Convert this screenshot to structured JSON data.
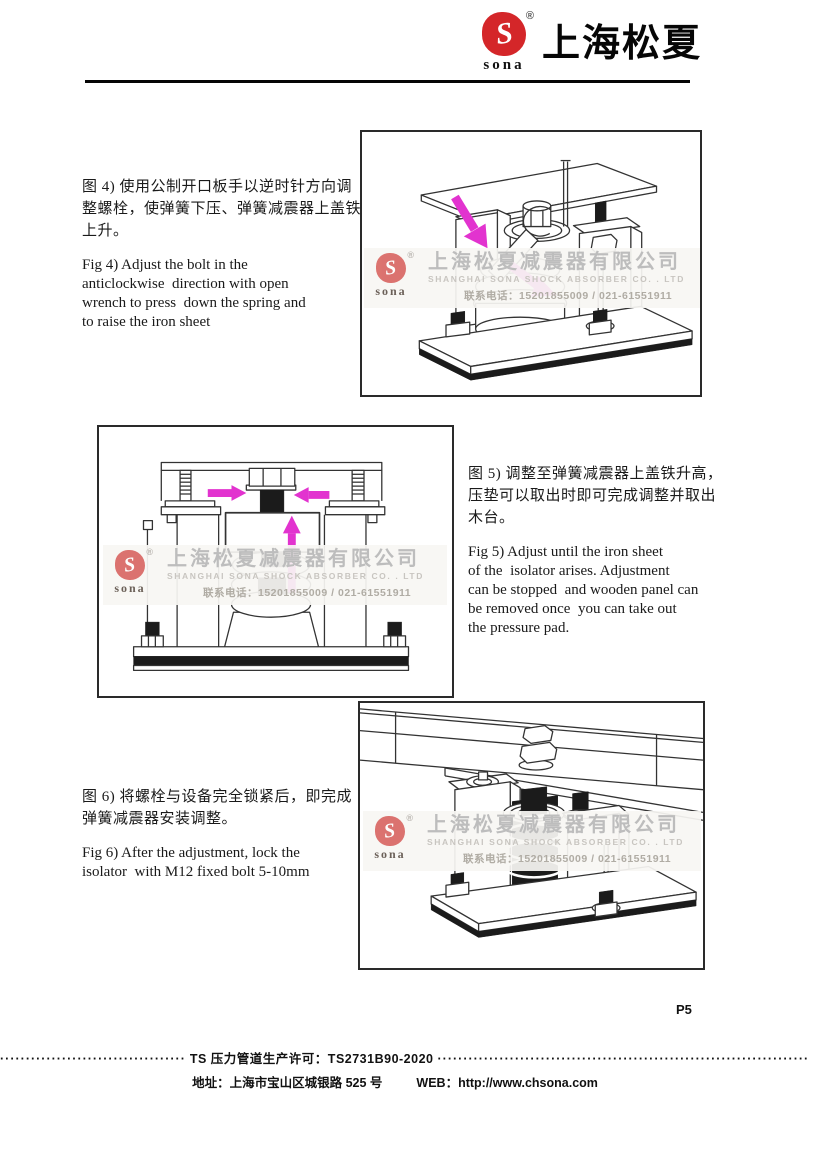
{
  "header": {
    "brand": "上海松夏",
    "logo_text": "sona",
    "reg": "®"
  },
  "sections": {
    "fig4": {
      "zh": [
        "图 4) 使用公制开口板手以逆时针方向调",
        "整螺栓，使弹簧下压、弹簧减震器上盖铁",
        "上升。"
      ],
      "en": [
        "Fig 4) Adjust the bolt in the",
        "anticlockwise  direction with open",
        "wrench to press  down the spring and",
        "to raise the iron sheet"
      ]
    },
    "fig5": {
      "zh": [
        "图 5) 调整至弹簧减震器上盖铁升高，",
        "压垫可以取出时即可完成调整并取出",
        "木台。"
      ],
      "en": [
        "Fig 5) Adjust until the iron sheet",
        "of the  isolator arises. Adjustment",
        "can be stopped  and wooden panel can",
        "be removed once  you can take out",
        "the pressure pad."
      ]
    },
    "fig6": {
      "zh": [
        "图 6) 将螺栓与设备完全锁紧后，即完成",
        "弹簧减震器安装调整。"
      ],
      "en": [
        "Fig 6) After the adjustment, lock the",
        "isolator  with M12 fixed bolt 5-10mm"
      ]
    }
  },
  "watermark": {
    "logo_text": "sona",
    "reg": "®",
    "company_zh": "上海松夏减震器有限公司",
    "company_en": "SHANGHAI SONA SHOCK ABSORBER CO. . LTD",
    "phone_line": "联系电话：15201855009 / 021-61551911"
  },
  "page_number": "P5",
  "footer": {
    "dots_left": "····································",
    "license": "TS 压力管道生产许可：TS2731B90-2020",
    "dots_right": "········································································",
    "address_label": "地址：",
    "address": "上海市宝山区城银路 525 号",
    "web_label": "WEB：",
    "web": "http://www.chsona.com"
  },
  "colors": {
    "arrow_magenta": "#e233cf",
    "logo_red": "#d42629",
    "watermark_gray": "#bdbdbd",
    "line_dark": "#333333"
  }
}
